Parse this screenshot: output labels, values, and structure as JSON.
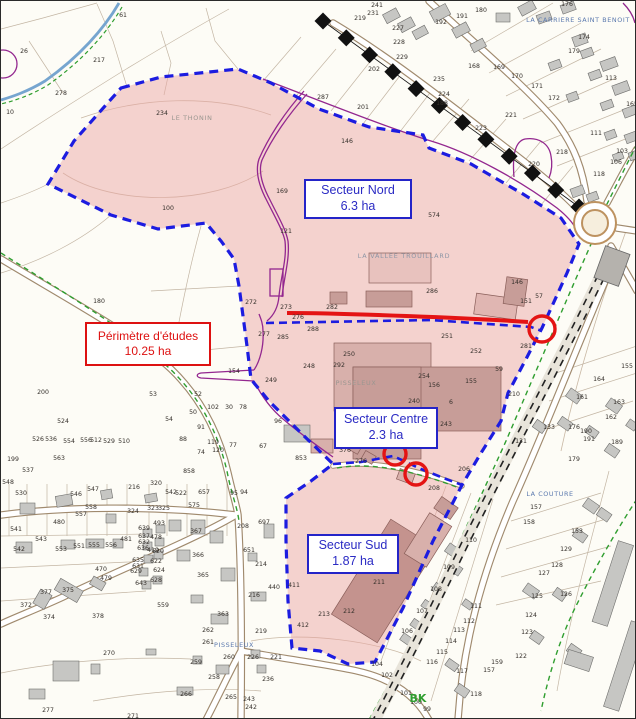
{
  "map": {
    "sectors": [
      {
        "id": "perimetre",
        "name": "Périmètre d'études",
        "area": "10.25 ha",
        "color": "#dd1111"
      },
      {
        "id": "nord",
        "name": "Secteur Nord",
        "area": "6.3 ha",
        "color": "#2424c8"
      },
      {
        "id": "centre",
        "name": "Secteur Centre",
        "area": "2.3 ha",
        "color": "#2424c8"
      },
      {
        "id": "sud",
        "name": "Secteur Sud",
        "area": "1.87 ha",
        "color": "#2424c8"
      }
    ],
    "place_names": [
      {
        "text": "LA CARRIERE SAINT BENOIT",
        "x": 577,
        "y": 21,
        "style": "blue"
      },
      {
        "text": "LA VALLEE TROUILLARD",
        "x": 403,
        "y": 257,
        "style": "grayblue"
      },
      {
        "text": "LE THONIN",
        "x": 191,
        "y": 119,
        "style": "gray"
      },
      {
        "text": "PISSELEUX",
        "x": 355,
        "y": 384,
        "style": "gray"
      },
      {
        "text": "PISSELEUX",
        "x": 233,
        "y": 646,
        "style": "blue"
      },
      {
        "text": "LA COUTURE",
        "x": 549,
        "y": 495,
        "style": "blue"
      },
      {
        "text": "BK",
        "x": 417,
        "y": 701,
        "style": "green"
      }
    ],
    "parcel_numbers": [
      [
        "61",
        122,
        16
      ],
      [
        "26",
        23,
        52
      ],
      [
        "217",
        98,
        61
      ],
      [
        "278",
        60,
        94
      ],
      [
        "10",
        9,
        113
      ],
      [
        "234",
        161,
        114
      ],
      [
        "100",
        167,
        209
      ],
      [
        "169",
        281,
        192
      ],
      [
        "121",
        285,
        232
      ],
      [
        "180",
        98,
        302
      ],
      [
        "200",
        42,
        393
      ],
      [
        "241",
        376,
        6
      ],
      [
        "231",
        372,
        14
      ],
      [
        "219",
        359,
        19
      ],
      [
        "227",
        397,
        29
      ],
      [
        "228",
        398,
        43
      ],
      [
        "229",
        401,
        58
      ],
      [
        "202",
        373,
        70
      ],
      [
        "235",
        438,
        80
      ],
      [
        "224",
        443,
        95
      ],
      [
        "188",
        441,
        104
      ],
      [
        "192",
        440,
        23
      ],
      [
        "191",
        461,
        17
      ],
      [
        "180",
        480,
        11
      ],
      [
        "176",
        566,
        5
      ],
      [
        "174",
        583,
        38
      ],
      [
        "179",
        573,
        52
      ],
      [
        "113",
        610,
        79
      ],
      [
        "168",
        473,
        67
      ],
      [
        "169",
        498,
        68
      ],
      [
        "170",
        516,
        77
      ],
      [
        "171",
        536,
        87
      ],
      [
        "172",
        553,
        99
      ],
      [
        "221",
        510,
        116
      ],
      [
        "223",
        480,
        129
      ],
      [
        "111",
        595,
        134
      ],
      [
        "218",
        561,
        153
      ],
      [
        "220",
        533,
        165
      ],
      [
        "103",
        621,
        152
      ],
      [
        "106",
        615,
        163
      ],
      [
        "118",
        598,
        175
      ],
      [
        "287",
        322,
        98
      ],
      [
        "201",
        362,
        108
      ],
      [
        "146",
        346,
        142
      ],
      [
        "574",
        433,
        216
      ],
      [
        "165",
        631,
        105
      ],
      [
        "272",
        250,
        303
      ],
      [
        "273",
        285,
        308
      ],
      [
        "276",
        297,
        318
      ],
      [
        "277",
        263,
        335
      ],
      [
        "285",
        282,
        338
      ],
      [
        "288",
        312,
        330
      ],
      [
        "248",
        308,
        367
      ],
      [
        "249",
        270,
        381
      ],
      [
        "154",
        233,
        372
      ],
      [
        "286",
        431,
        292
      ],
      [
        "146",
        516,
        283
      ],
      [
        "151",
        525,
        302
      ],
      [
        "57",
        538,
        297
      ],
      [
        "282",
        331,
        308
      ],
      [
        "251",
        446,
        337
      ],
      [
        "252",
        475,
        352
      ],
      [
        "250",
        348,
        355
      ],
      [
        "292",
        338,
        366
      ],
      [
        "254",
        423,
        377
      ],
      [
        "155",
        470,
        382
      ],
      [
        "59",
        498,
        370
      ],
      [
        "156",
        433,
        386
      ],
      [
        "281",
        525,
        347
      ],
      [
        "240",
        413,
        402
      ],
      [
        "6",
        450,
        403
      ],
      [
        "243",
        445,
        425
      ],
      [
        "255",
        430,
        428
      ],
      [
        "210",
        513,
        395
      ],
      [
        "276",
        360,
        462
      ],
      [
        "206",
        463,
        470
      ],
      [
        "131",
        520,
        442
      ],
      [
        "376",
        344,
        451
      ],
      [
        "164",
        598,
        380
      ],
      [
        "161",
        581,
        398
      ],
      [
        "163",
        618,
        403
      ],
      [
        "162",
        610,
        418
      ],
      [
        "155",
        626,
        367
      ],
      [
        "176",
        573,
        428
      ],
      [
        "190",
        585,
        432
      ],
      [
        "191",
        588,
        440
      ],
      [
        "189",
        616,
        443
      ],
      [
        "179",
        573,
        460
      ],
      [
        "133",
        548,
        428
      ],
      [
        "53",
        152,
        395
      ],
      [
        "54",
        168,
        420
      ],
      [
        "52",
        197,
        395
      ],
      [
        "50",
        192,
        413
      ],
      [
        "102",
        212,
        408
      ],
      [
        "30",
        228,
        408
      ],
      [
        "78",
        242,
        408
      ],
      [
        "91",
        200,
        428
      ],
      [
        "96",
        277,
        422
      ],
      [
        "88",
        182,
        440
      ],
      [
        "67",
        262,
        447
      ],
      [
        "119",
        212,
        443
      ],
      [
        "74",
        200,
        453
      ],
      [
        "120",
        217,
        451
      ],
      [
        "77",
        232,
        446
      ],
      [
        "524",
        62,
        422
      ],
      [
        "526",
        37,
        440
      ],
      [
        "536",
        50,
        440
      ],
      [
        "554",
        68,
        442
      ],
      [
        "556",
        85,
        441
      ],
      [
        "512",
        95,
        441
      ],
      [
        "529",
        108,
        442
      ],
      [
        "510",
        123,
        442
      ],
      [
        "563",
        58,
        459
      ],
      [
        "199",
        12,
        460
      ],
      [
        "537",
        27,
        471
      ],
      [
        "853",
        300,
        459
      ],
      [
        "858",
        188,
        472
      ],
      [
        "548",
        7,
        483
      ],
      [
        "530",
        20,
        494
      ],
      [
        "546",
        75,
        495
      ],
      [
        "547",
        92,
        490
      ],
      [
        "216",
        133,
        488
      ],
      [
        "320",
        155,
        484
      ],
      [
        "542",
        170,
        493
      ],
      [
        "522",
        180,
        494
      ],
      [
        "657",
        203,
        493
      ],
      [
        "95",
        233,
        494
      ],
      [
        "94",
        243,
        493
      ],
      [
        "575",
        193,
        506
      ],
      [
        "323",
        152,
        509
      ],
      [
        "325",
        163,
        509
      ],
      [
        "324",
        132,
        512
      ],
      [
        "558",
        90,
        508
      ],
      [
        "557",
        80,
        515
      ],
      [
        "541",
        15,
        530
      ],
      [
        "543",
        40,
        540
      ],
      [
        "542",
        18,
        550
      ],
      [
        "553",
        60,
        550
      ],
      [
        "551",
        78,
        547
      ],
      [
        "555",
        93,
        546
      ],
      [
        "556",
        110,
        546
      ],
      [
        "480",
        58,
        523
      ],
      [
        "481",
        125,
        540
      ],
      [
        "639",
        143,
        529
      ],
      [
        "637",
        143,
        537
      ],
      [
        "632",
        143,
        543
      ],
      [
        "636",
        142,
        549
      ],
      [
        "635",
        137,
        561
      ],
      [
        "631",
        137,
        567
      ],
      [
        "629",
        135,
        572
      ],
      [
        "643",
        140,
        584
      ],
      [
        "493",
        158,
        524
      ],
      [
        "478",
        155,
        538
      ],
      [
        "419",
        152,
        551
      ],
      [
        "620",
        157,
        552
      ],
      [
        "622",
        155,
        562
      ],
      [
        "624",
        158,
        571
      ],
      [
        "628",
        155,
        581
      ],
      [
        "470",
        100,
        570
      ],
      [
        "479",
        105,
        579
      ],
      [
        "375",
        67,
        591
      ],
      [
        "377",
        45,
        593
      ],
      [
        "372",
        25,
        606
      ],
      [
        "374",
        48,
        618
      ],
      [
        "378",
        97,
        617
      ],
      [
        "559",
        162,
        606
      ],
      [
        "367",
        195,
        532
      ],
      [
        "366",
        197,
        556
      ],
      [
        "365",
        202,
        576
      ],
      [
        "363",
        222,
        615
      ],
      [
        "262",
        207,
        631
      ],
      [
        "261",
        207,
        643
      ],
      [
        "260",
        228,
        658
      ],
      [
        "259",
        195,
        663
      ],
      [
        "258",
        213,
        678
      ],
      [
        "265",
        230,
        698
      ],
      [
        "266",
        185,
        695
      ],
      [
        "270",
        108,
        654
      ],
      [
        "277",
        47,
        711
      ],
      [
        "271",
        132,
        717
      ],
      [
        "208",
        242,
        527
      ],
      [
        "697",
        263,
        523
      ],
      [
        "651",
        248,
        551
      ],
      [
        "214",
        260,
        565
      ],
      [
        "440",
        273,
        588
      ],
      [
        "216",
        253,
        596
      ],
      [
        "411",
        293,
        586
      ],
      [
        "412",
        302,
        626
      ],
      [
        "219",
        260,
        632
      ],
      [
        "221",
        275,
        658
      ],
      [
        "226",
        252,
        658
      ],
      [
        "236",
        267,
        680
      ],
      [
        "243",
        248,
        700
      ],
      [
        "242",
        250,
        708
      ],
      [
        "208",
        433,
        489
      ],
      [
        "211",
        378,
        583
      ],
      [
        "212",
        348,
        612
      ],
      [
        "213",
        323,
        615
      ],
      [
        "109",
        448,
        568
      ],
      [
        "108",
        435,
        590
      ],
      [
        "107",
        421,
        612
      ],
      [
        "106",
        406,
        632
      ],
      [
        "111",
        475,
        607
      ],
      [
        "112",
        468,
        622
      ],
      [
        "113",
        458,
        631
      ],
      [
        "114",
        450,
        642
      ],
      [
        "115",
        441,
        653
      ],
      [
        "116",
        431,
        663
      ],
      [
        "117",
        461,
        672
      ],
      [
        "118",
        475,
        695
      ],
      [
        "110",
        470,
        541
      ],
      [
        "104",
        376,
        665
      ],
      [
        "102",
        386,
        676
      ],
      [
        "101",
        405,
        694
      ],
      [
        "100",
        415,
        703
      ],
      [
        "99",
        426,
        710
      ],
      [
        "157",
        488,
        671
      ],
      [
        "159",
        496,
        663
      ],
      [
        "122",
        520,
        657
      ],
      [
        "123",
        526,
        633
      ],
      [
        "124",
        530,
        616
      ],
      [
        "125",
        536,
        597
      ],
      [
        "126",
        565,
        595
      ],
      [
        "127",
        543,
        574
      ],
      [
        "128",
        556,
        566
      ],
      [
        "129",
        565,
        550
      ],
      [
        "153",
        576,
        532
      ],
      [
        "158",
        528,
        523
      ],
      [
        "157",
        535,
        508
      ]
    ],
    "colors": {
      "study_area_fill": "#eba8a5",
      "perimeter_blue": "#1c1ce0",
      "annotation_red": "#e41414",
      "railway_black": "#111111",
      "green_boundary": "#2f9e2f",
      "zoning_purple": "#93278f",
      "water_blue": "#76a5cf",
      "building_gray": "#c6c6c3",
      "building_mauve": "#c79d98",
      "road_casing": "#a08a6e"
    }
  }
}
